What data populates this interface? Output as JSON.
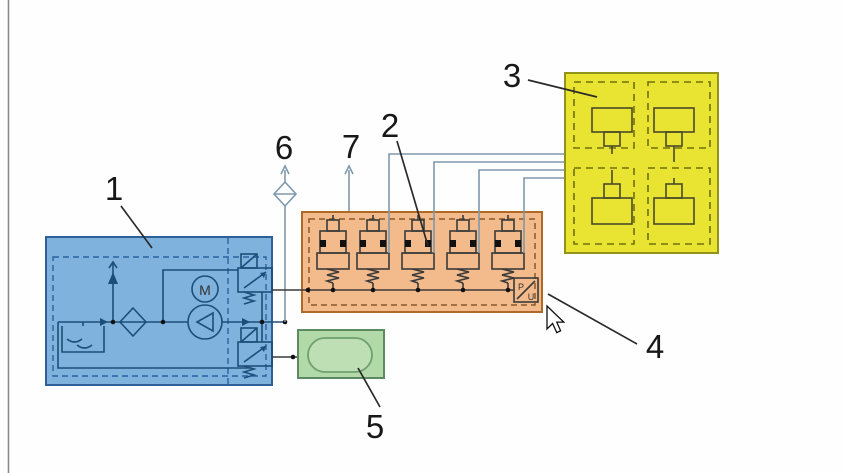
{
  "callouts": {
    "label_1": "1",
    "label_2": "2",
    "label_3": "3",
    "label_4": "4",
    "label_5": "5",
    "label_6": "6",
    "label_7": "7"
  },
  "symbols": {
    "motor": "M",
    "transducer_p": "P",
    "transducer_u": "U"
  },
  "colors": {
    "power_unit_fill": "#7fb2dc",
    "manifold_fill": "#f3bb8b",
    "actuators_fill": "#e9e431",
    "accumulator_fill": "#b2d9a8",
    "interconnect_line": "#7e98ab"
  }
}
